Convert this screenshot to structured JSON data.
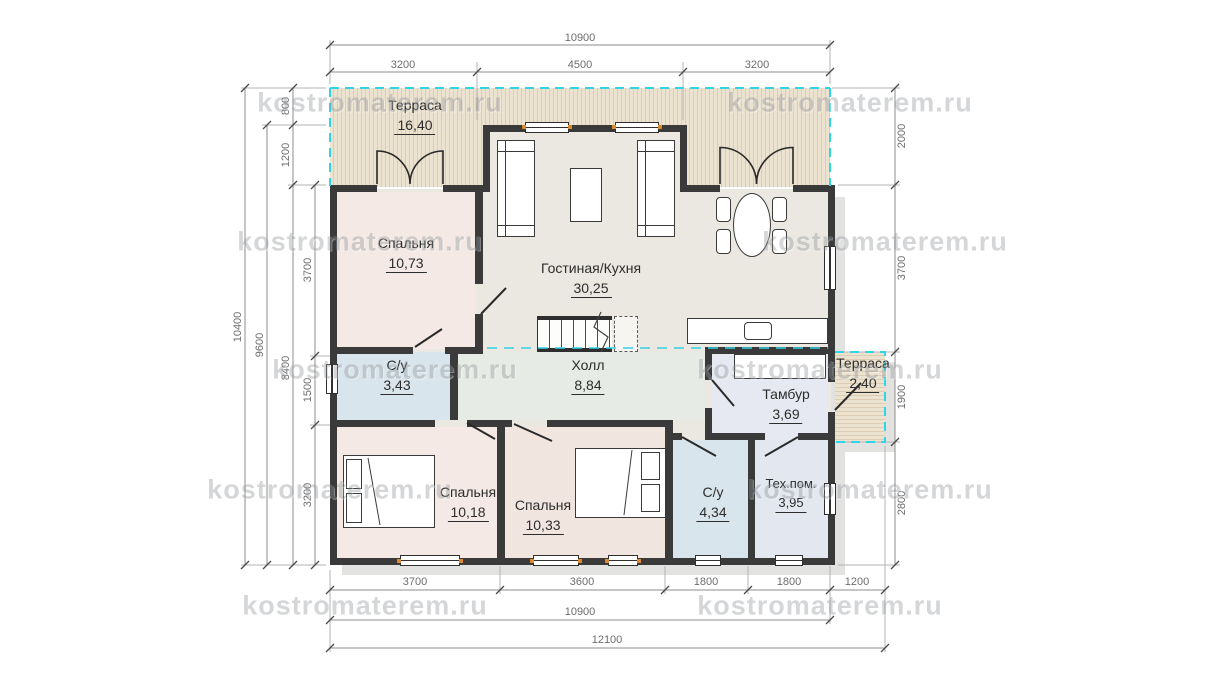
{
  "watermark": "kostromaterem.ru",
  "rooms": {
    "terrace_top": {
      "name": "Терраса",
      "area": "16,40"
    },
    "bedroom_master": {
      "name": "Спальня",
      "area": "10,73"
    },
    "living_kitchen": {
      "name": "Гостиная/Кухня",
      "area": "30,25"
    },
    "hall": {
      "name": "Холл",
      "area": "8,84"
    },
    "wc_1": {
      "name": "С/у",
      "area": "3,43"
    },
    "tambour": {
      "name": "Тамбур",
      "area": "3,69"
    },
    "terrace_right": {
      "name": "Терраса",
      "area": "2,40"
    },
    "bedroom_2": {
      "name": "Спальня",
      "area": "10,18"
    },
    "bedroom_3": {
      "name": "Спальня",
      "area": "10,33"
    },
    "wc_2": {
      "name": "С/у",
      "area": "4,34"
    },
    "tech_room": {
      "name": "Тех.пом.",
      "area": "3,95"
    }
  },
  "dimensions": {
    "top": {
      "total": "10900",
      "segments": [
        "3200",
        "4500",
        "3200"
      ]
    },
    "bottom": {
      "segments": [
        "3700",
        "3600",
        "1800",
        "1800",
        "1200"
      ],
      "inner_total": "10900",
      "overall": "12100"
    },
    "left": {
      "overall": "10400",
      "mid": "9600",
      "chain": [
        "800",
        "1200",
        "8400"
      ],
      "inner": [
        "3700",
        "1500",
        "3200"
      ]
    },
    "right": {
      "segments": [
        "2000",
        "3700",
        "1900",
        "2800"
      ]
    }
  },
  "colors": {
    "roof_outline_cyan": "#2fd4e6",
    "wall": "#3a3a3a",
    "terrace_fill": "#ece2d0",
    "bedroom_fill": "#f4e9e4",
    "wet_room_fill": "#d9e5ec",
    "living_fill": "#ebe8e1",
    "window_frame_tick": "#dd8a2e"
  }
}
